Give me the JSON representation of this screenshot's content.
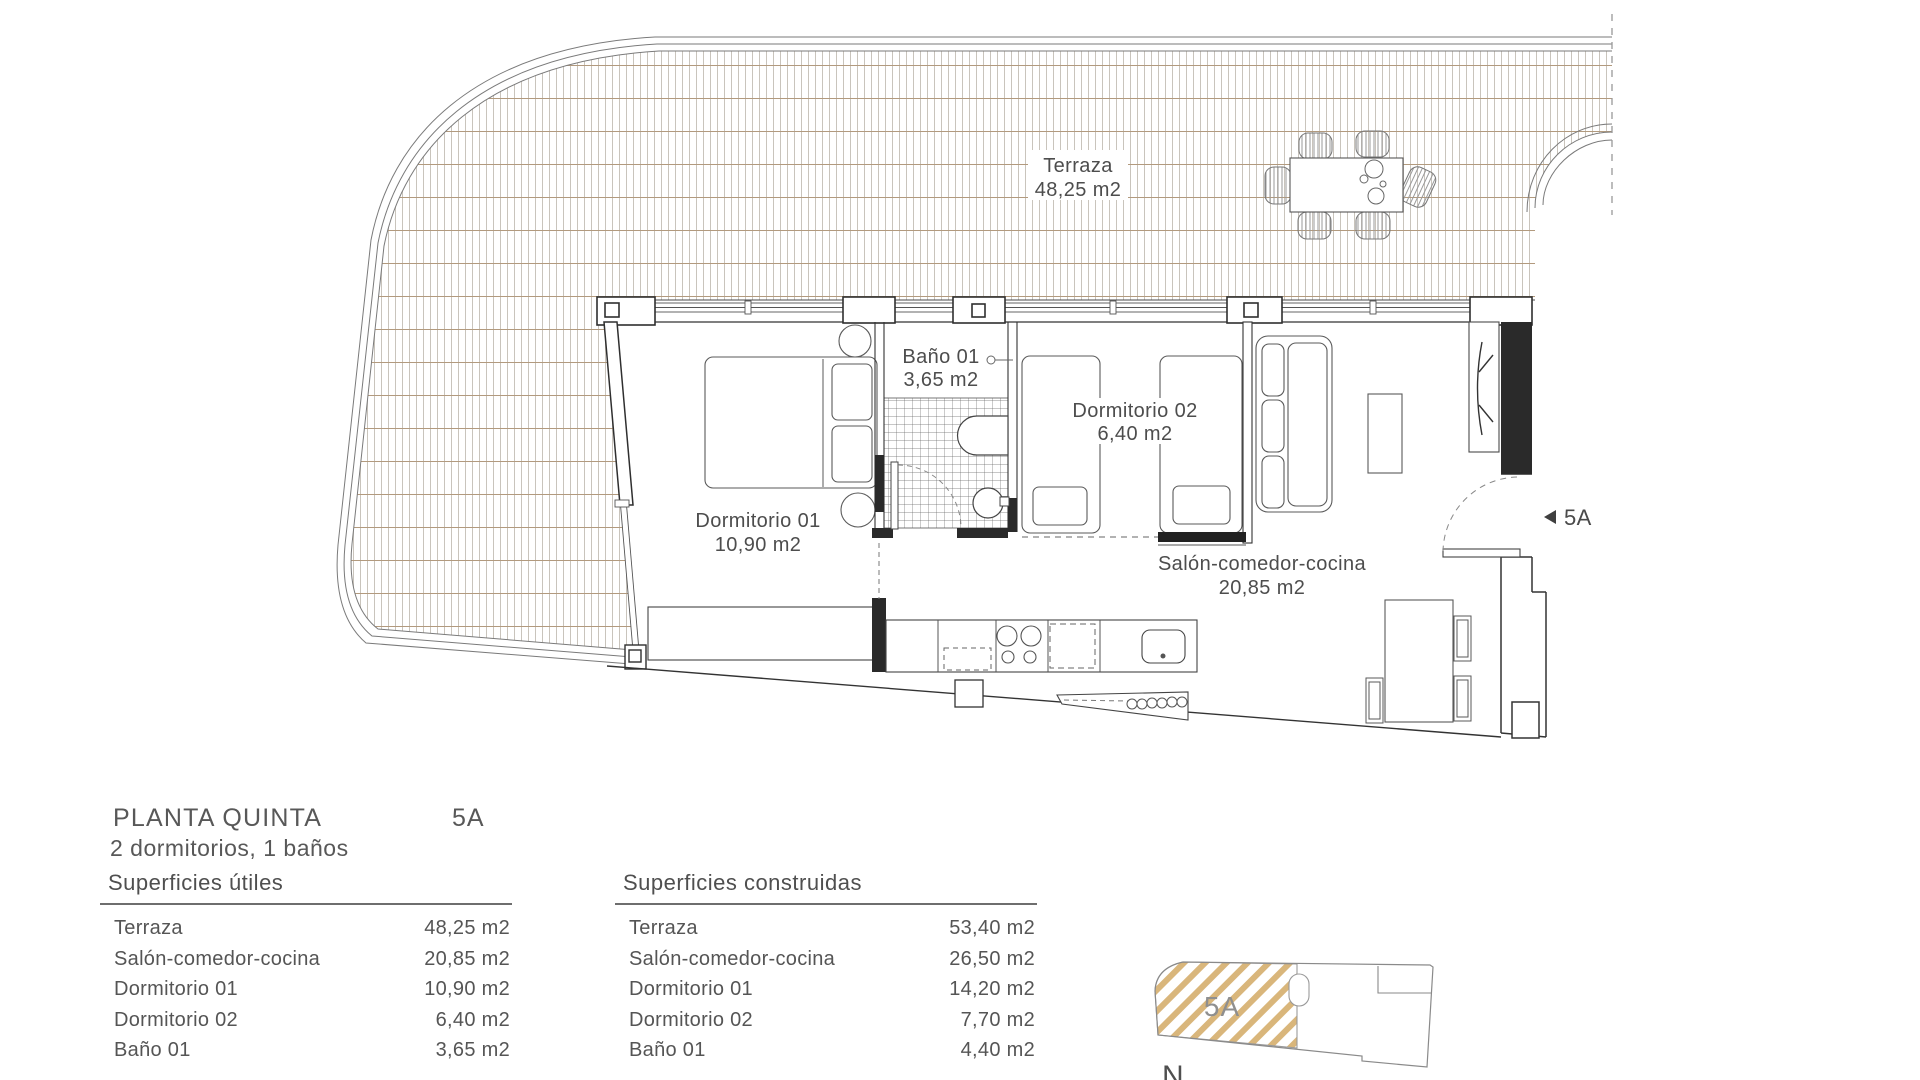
{
  "plan": {
    "terraza": {
      "name": "Terraza",
      "area": "48,25 m2"
    },
    "bano": {
      "name": "Baño 01",
      "area": "3,65 m2"
    },
    "dorm1": {
      "name": "Dormitorio 01",
      "area": "10,90 m2"
    },
    "dorm2": {
      "name": "Dormitorio 02",
      "area": "6,40 m2"
    },
    "salon": {
      "name": "Salón-comedor-cocina",
      "area": "20,85 m2"
    },
    "entry_marker": "5A"
  },
  "info": {
    "title": "PLANTA QUINTA",
    "unit": "5A",
    "subtitle": "2 dormitorios, 1 baños"
  },
  "tables": {
    "utiles": {
      "header": "Superficies útiles",
      "rows": [
        {
          "label": "Terraza",
          "value": "48,25 m2"
        },
        {
          "label": "Salón-comedor-cocina",
          "value": "20,85 m2"
        },
        {
          "label": "Dormitorio 01",
          "value": "10,90 m2"
        },
        {
          "label": "Dormitorio 02",
          "value": "6,40 m2"
        },
        {
          "label": "Baño 01",
          "value": "3,65 m2"
        }
      ]
    },
    "construidas": {
      "header": "Superficies construidas",
      "rows": [
        {
          "label": "Terraza",
          "value": "53,40 m2"
        },
        {
          "label": "Salón-comedor-cocina",
          "value": "26,50 m2"
        },
        {
          "label": "Dormitorio 01",
          "value": "14,20 m2"
        },
        {
          "label": "Dormitorio 02",
          "value": "7,70 m2"
        },
        {
          "label": "Baño 01",
          "value": "4,40 m2"
        }
      ]
    }
  },
  "minimap": {
    "unit_label": "5A",
    "north_label": "N"
  },
  "colors": {
    "wall": "#2f2f2f",
    "line": "#555555",
    "deck_vertical": "#c9c4bc",
    "deck_horizontal": "#b29a7e",
    "map_hatch_gold": "#d3a964",
    "text": "#4d4d4d"
  }
}
